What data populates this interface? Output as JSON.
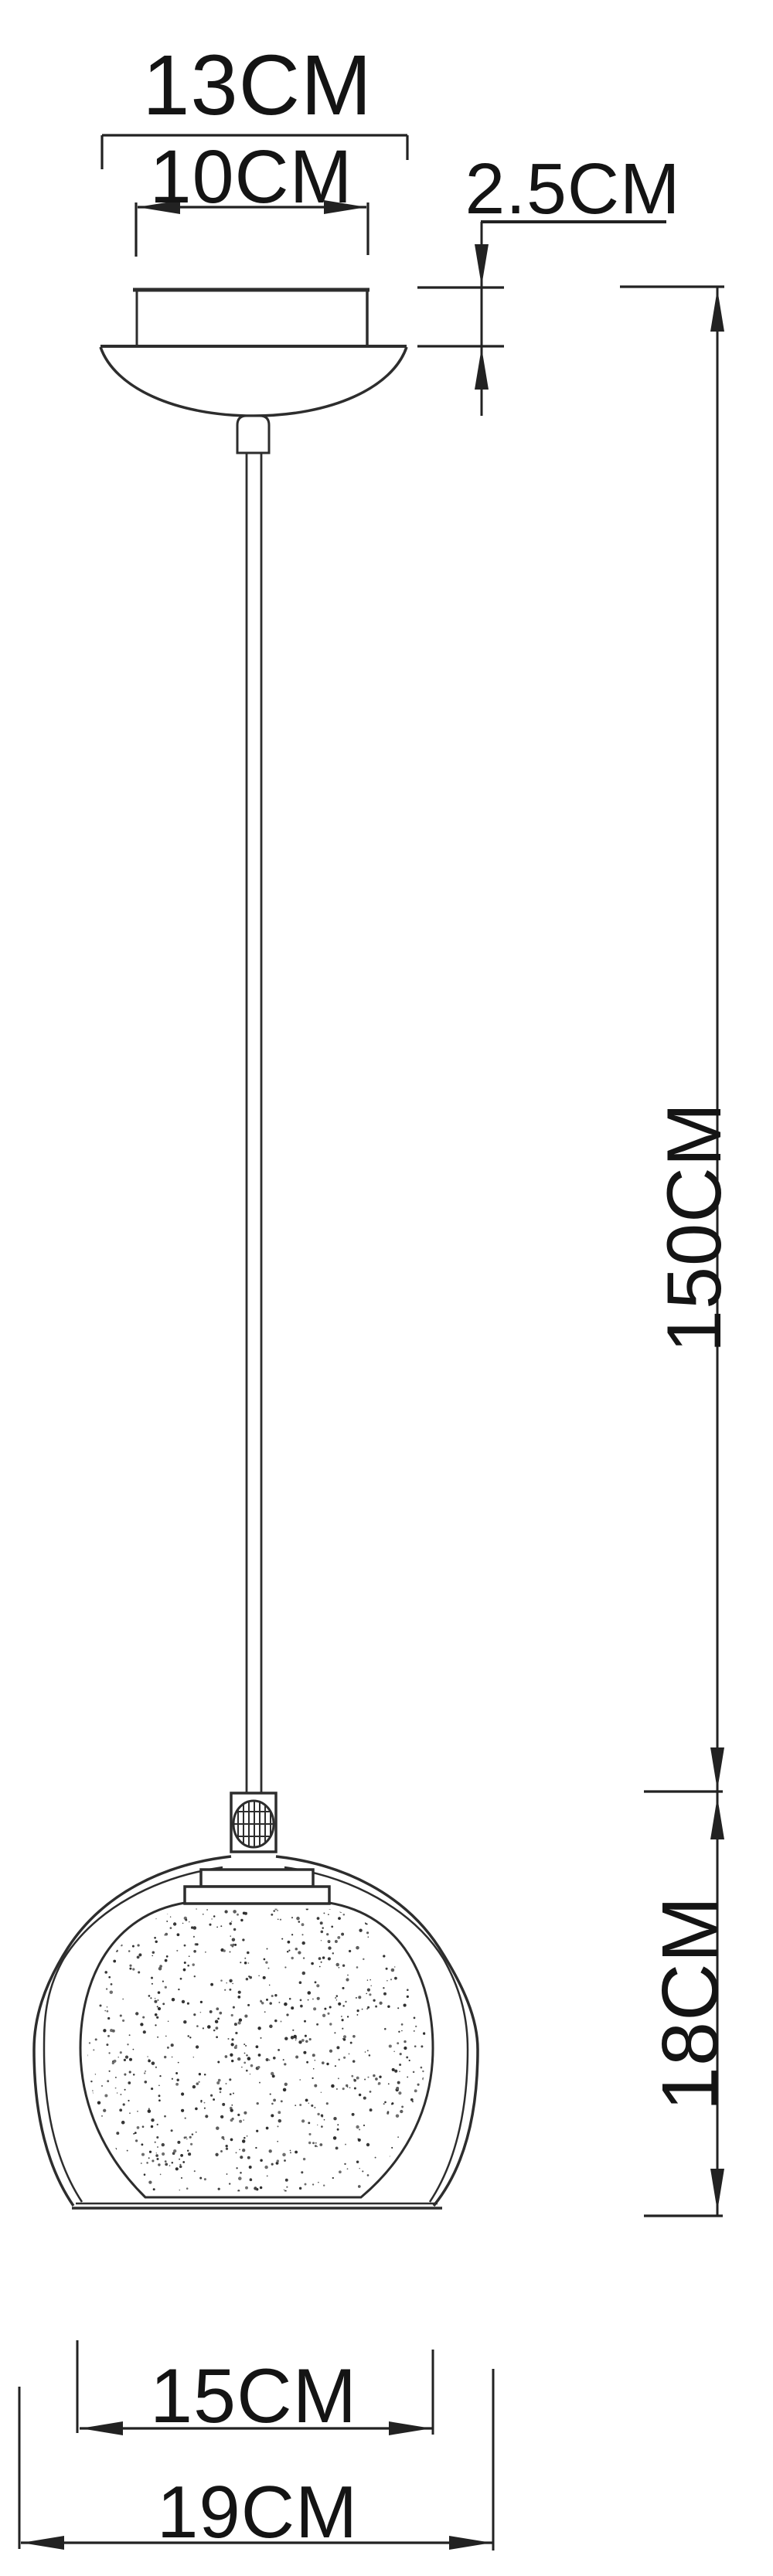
{
  "page": {
    "background_color": "#ffffff",
    "line_color": "#2d2d2d",
    "text_color": "#141414"
  },
  "diagram": {
    "type": "technical-dimension-drawing",
    "subject": "pendant-lamp",
    "dimensions": {
      "canopy_outer_width": "13CM",
      "canopy_inner_width": "10CM",
      "canopy_height": "2.5CM",
      "cord_length": "150CM",
      "shade_height": "18CM",
      "shade_inner_width": "15CM",
      "shade_outer_width": "19CM"
    }
  }
}
